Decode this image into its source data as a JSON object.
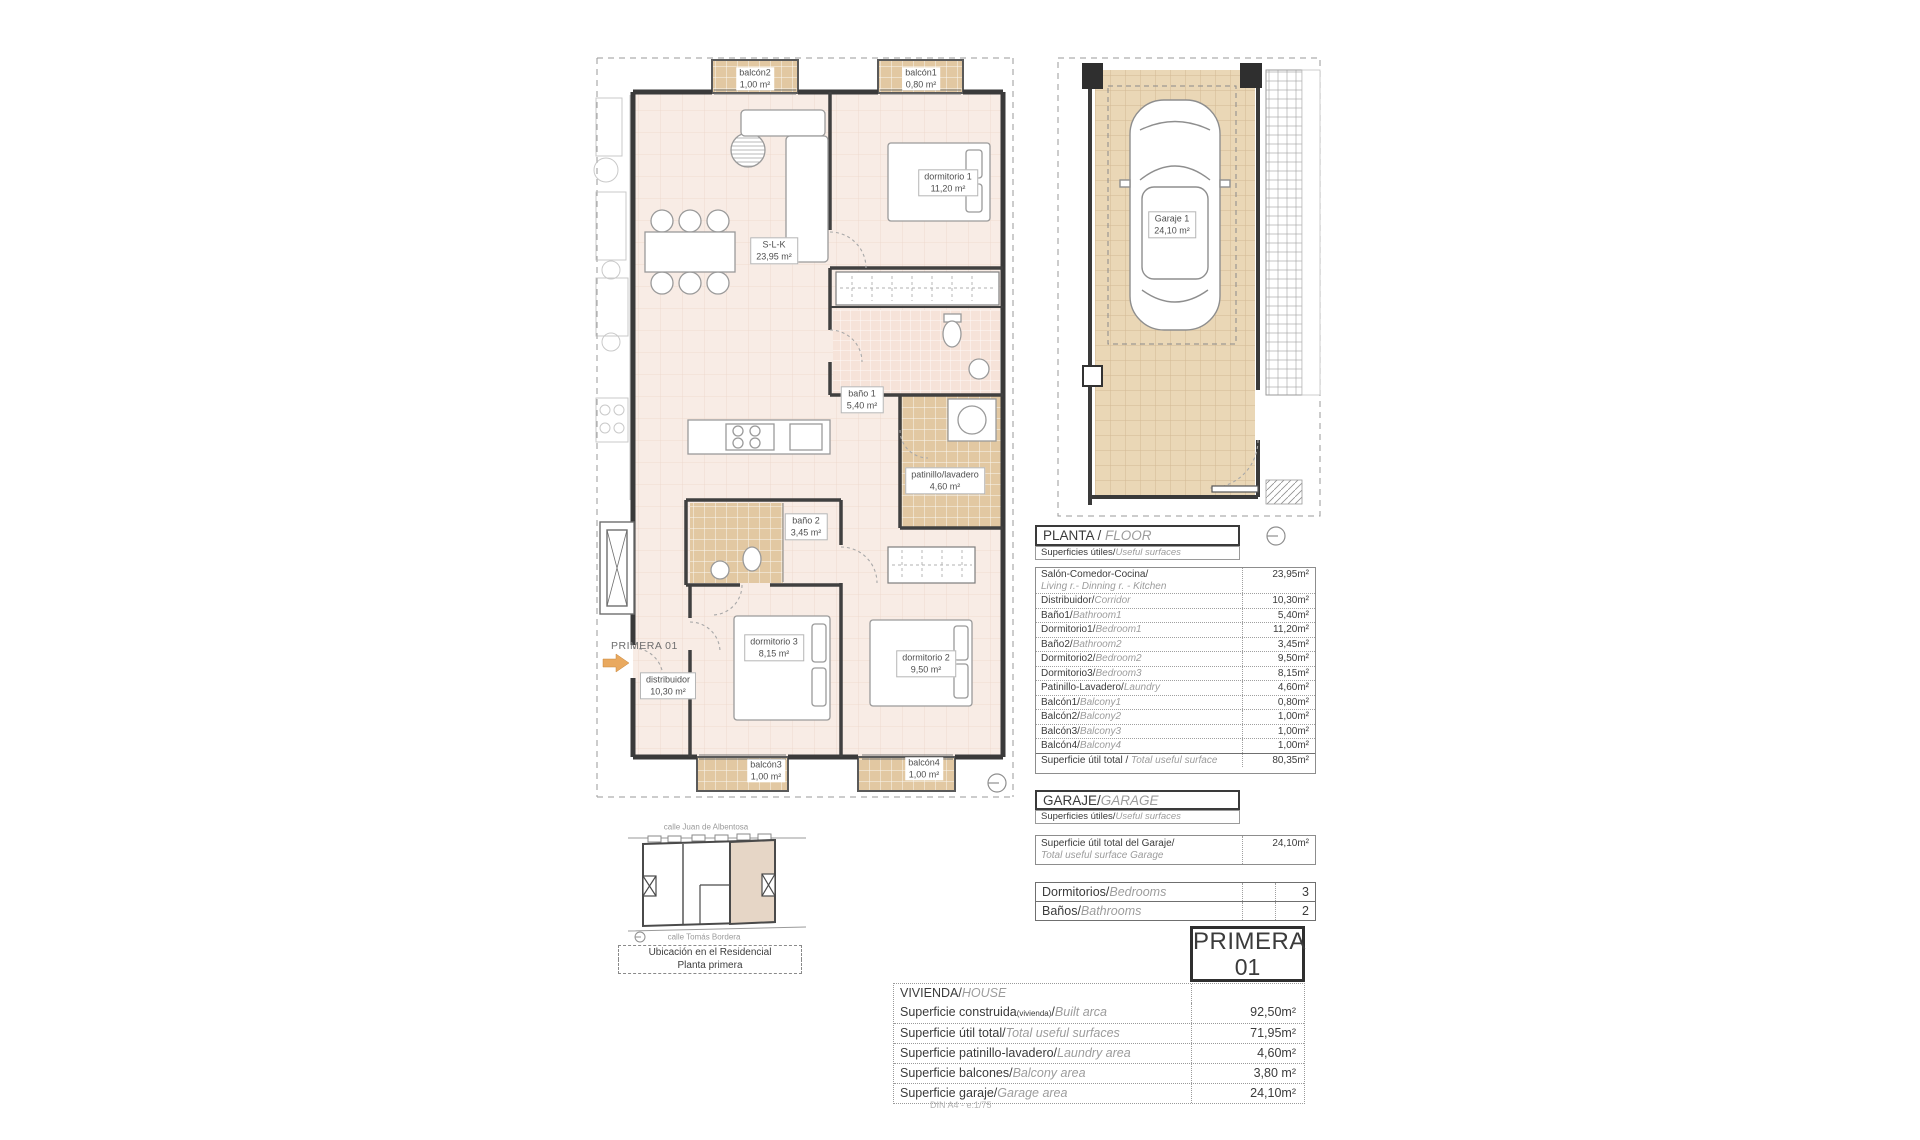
{
  "plan": {
    "marker": "PRIMERA 01",
    "rooms": {
      "balcon2": {
        "name": "balcón2",
        "area": "1,00 m²"
      },
      "balcon1": {
        "name": "balcón1",
        "area": "0,80 m²"
      },
      "dormitorio1": {
        "name": "dormitorio 1",
        "area": "11,20 m²"
      },
      "slk": {
        "name": "S-L-K",
        "area": "23,95 m²"
      },
      "bano1": {
        "name": "baño 1",
        "area": "5,40 m²"
      },
      "patinillo": {
        "name": "patinillo/lavadero",
        "area": "4,60 m²"
      },
      "bano2": {
        "name": "baño 2",
        "area": "3,45 m²"
      },
      "dormitorio3": {
        "name": "dormitorio 3",
        "area": "8,15 m²"
      },
      "dormitorio2": {
        "name": "dormitorio 2",
        "area": "9,50 m²"
      },
      "distribuidor": {
        "name": "distribuidor",
        "area": "10,30 m²"
      },
      "balcon3": {
        "name": "balcón3",
        "area": "1,00 m²"
      },
      "balcon4": {
        "name": "balcón4",
        "area": "1,00 m²"
      }
    }
  },
  "garage_plan": {
    "garaje1": {
      "name": "Garaje 1",
      "area": "24,10 m²"
    }
  },
  "floor_section": {
    "title_es": "PLANTA / ",
    "title_en": "FLOOR",
    "subtitle_es": "Superficies útiles/",
    "subtitle_en": "Useful surfaces",
    "rows": [
      {
        "es": "Salón-Comedor-Cocina/",
        "en": "Living r.- Dinning r. - Kitchen",
        "value": "23,95m²",
        "two_line": true
      },
      {
        "es": "Distribuidor/",
        "en": "Corridor",
        "value": "10,30m²"
      },
      {
        "es": "Baño1/",
        "en": "Bathroom1",
        "value": "5,40m²"
      },
      {
        "es": "Dormitorio1/",
        "en": "Bedroom1",
        "value": "11,20m²"
      },
      {
        "es": "Baño2/",
        "en": "Bathroom2",
        "value": "3,45m²"
      },
      {
        "es": "Dormitorio2/",
        "en": "Bedroom2",
        "value": "9,50m²"
      },
      {
        "es": "Dormitorio3/",
        "en": "Bedroom3",
        "value": "8,15m²"
      },
      {
        "es": "Patinillo-Lavadero/",
        "en": "Laundry",
        "value": "4,60m²"
      },
      {
        "es": "Balcón1/",
        "en": "Balcony1",
        "value": "0,80m²"
      },
      {
        "es": "Balcón2/",
        "en": "Balcony2",
        "value": "1,00m²"
      },
      {
        "es": "Balcón3/",
        "en": "Balcony3",
        "value": "1,00m²"
      },
      {
        "es": "Balcón4/",
        "en": "Balcony4",
        "value": "1,00m²"
      },
      {
        "es": "Superficie útil total / ",
        "en": "Total useful surface",
        "value": "80,35m²",
        "total": true
      }
    ]
  },
  "garage_section": {
    "title_es": "GARAJE/",
    "title_en": "GARAGE",
    "subtitle_es": "Superficies útiles/",
    "subtitle_en": "Useful surfaces",
    "rows": [
      {
        "es": "Superficie útil total del Garaje/",
        "en": "Total useful surface Garage",
        "value": "24,10m²",
        "two_line": true
      }
    ]
  },
  "counts_section": {
    "rows": [
      {
        "es": "Dormitorios/",
        "en": "Bedrooms",
        "value": "3"
      },
      {
        "es": "Baños/",
        "en": "Bathrooms",
        "value": "2"
      }
    ]
  },
  "unit_badge": {
    "line1": "PRIMERA",
    "line2": "01"
  },
  "house_section": {
    "title_es": "VIVIENDA/",
    "title_en": "HOUSE",
    "rows": [
      {
        "es": "Superficie construida",
        "es_small": "(vivienda)",
        "tail": "/",
        "en": "Built arca",
        "value": "92,50m²"
      },
      {
        "es": "Superficie útil total/",
        "en": "Total useful surfaces",
        "value": "71,95m²"
      },
      {
        "es": "Superficie patinillo-lavadero/",
        "en": "Laundry area",
        "value": "4,60m²"
      },
      {
        "es": "Superficie balcones/",
        "en": "Balcony area",
        "value": "3,80 m²"
      },
      {
        "es": "Superficie garaje/",
        "en": "Garage area",
        "value": "24,10m²"
      }
    ]
  },
  "footer_note": "DIN A4 - e:1/75",
  "location_map": {
    "street_top": "calle Juan de Albentosa",
    "street_bottom": "calle Tomás Bordera",
    "caption_line1": "Ubicación en el Residencial",
    "caption_line2": "Planta primera"
  },
  "colors": {
    "tile_tan": "#e2c8a2",
    "garage_tile": "#ead7b6",
    "floor_pink": "#f8ece5",
    "bath_pink": "#f6e3d9",
    "wall": "#3a3a3a",
    "arrow_orange": "#e9a95f",
    "map_highlight": "#e6d6c6"
  }
}
